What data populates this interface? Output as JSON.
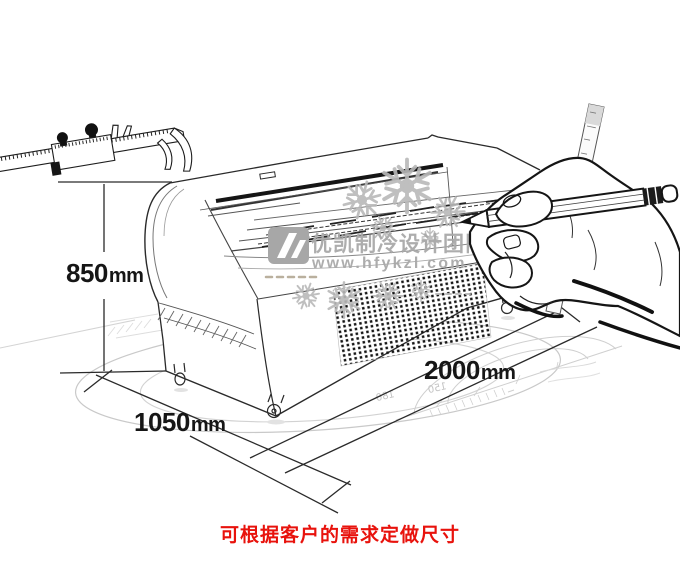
{
  "watermark": {
    "brand": "优凯制冷设计团队",
    "website": "www.hfykzl.com",
    "color": "#a9a9a9"
  },
  "dimensions": {
    "height": {
      "value": "850",
      "unit": "mm"
    },
    "depth": {
      "value": "1050",
      "unit": "mm"
    },
    "length": {
      "value": "2000",
      "unit": "mm"
    }
  },
  "protractor": {
    "labels": [
      "180",
      "150"
    ]
  },
  "footer": {
    "note": "可根据客户的需求定做尺寸",
    "color": "#e8120c"
  },
  "colors": {
    "ink": "#2a2a2a",
    "faint_floor": "#cccccc"
  }
}
